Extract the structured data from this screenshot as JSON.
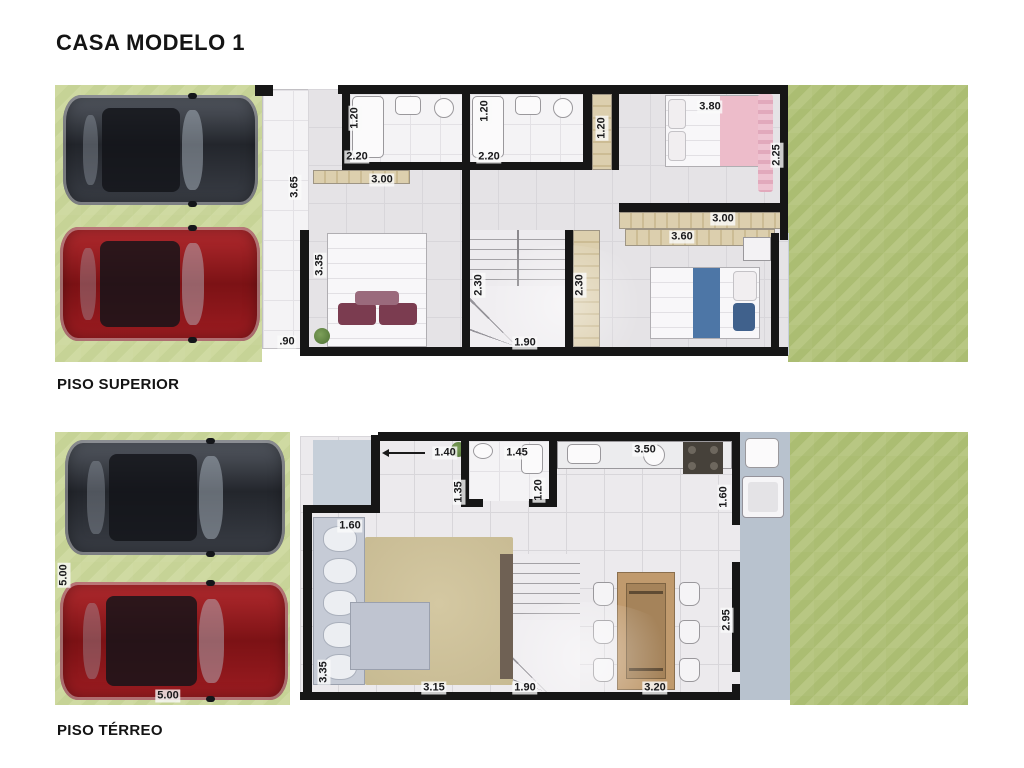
{
  "title": "CASA MODELO 1",
  "floors": {
    "superior": {
      "label": "PISO SUPERIOR",
      "dims": {
        "bath1_depth": "1.20",
        "bath1_width": "2.20",
        "bath2_depth": "1.20",
        "bath2_width": "2.20",
        "closet_top": "1.20",
        "suite_width": "3.80",
        "suite_depth": "2.25",
        "balcony_top": "3.65",
        "bedroom2_width": "3.00",
        "wardrobe_row1": "3.00",
        "wardrobe_row2": "3.60",
        "balcony_mid": "3.35",
        "stair_left": "2.30",
        "stair_right": "2.30",
        "stair_width": "1.90",
        "balcony_bottom": ".90"
      }
    },
    "terreo": {
      "label": "PISO TÉRREO",
      "dims": {
        "entry_door": "1.40",
        "bath_width": "1.45",
        "kitchen_width": "3.50",
        "hall_depth": "1.35",
        "bath_depth": "1.20",
        "sofa_width": "1.60",
        "service_width": "1.60",
        "garage_length": "5.00",
        "living_depth": "3.35",
        "rug_width": "3.15",
        "stair_width": "1.90",
        "dining_width": "3.20",
        "dining_depth": "2.95",
        "garage_width": "5.00"
      }
    }
  },
  "colors": {
    "wall": "#161616",
    "grass_front": "#cbd79d",
    "grass_back": "#aebf77",
    "floor_tile": "#e5e3e6",
    "wood": "#d6c9a8",
    "car_dark": "#33373e",
    "car_red": "#9d1c21",
    "walkway": "#c6cfd9"
  }
}
